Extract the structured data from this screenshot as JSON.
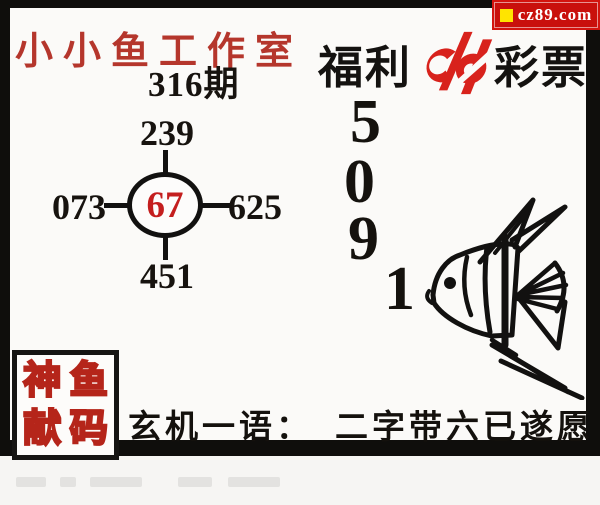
{
  "poster": {
    "badge": {
      "text": "cz89.com"
    },
    "studio_title": "小小鱼工作室",
    "issue": "316期",
    "brand": {
      "left": "福利",
      "right": "彩票"
    },
    "hub": {
      "top": "239",
      "left": "073",
      "center": "67",
      "right": "625",
      "bottom": "451"
    },
    "column_digits": [
      "5",
      "0",
      "9",
      "1"
    ],
    "seal": {
      "chars": [
        "神",
        "鱼",
        "献",
        "码"
      ]
    },
    "mystery": {
      "label": "玄机一语：",
      "phrase": "二字带六已遂愿"
    },
    "icons": {
      "logo": "china-welfare-lottery-logo",
      "fish": "angelfish-line-drawing",
      "badge_marker": "yellow-square-marker"
    },
    "colors": {
      "frame_black": "#0f0e0c",
      "panel_white": "#fbfaf8",
      "title_red": "#b5362c",
      "badge_red": "#c9100c",
      "badge_yellow": "#ffe400",
      "hub_center_red": "#c41e1e",
      "seal_red": "#b5251a",
      "logo_red": "#d8221c",
      "ink": "#17130f"
    }
  }
}
